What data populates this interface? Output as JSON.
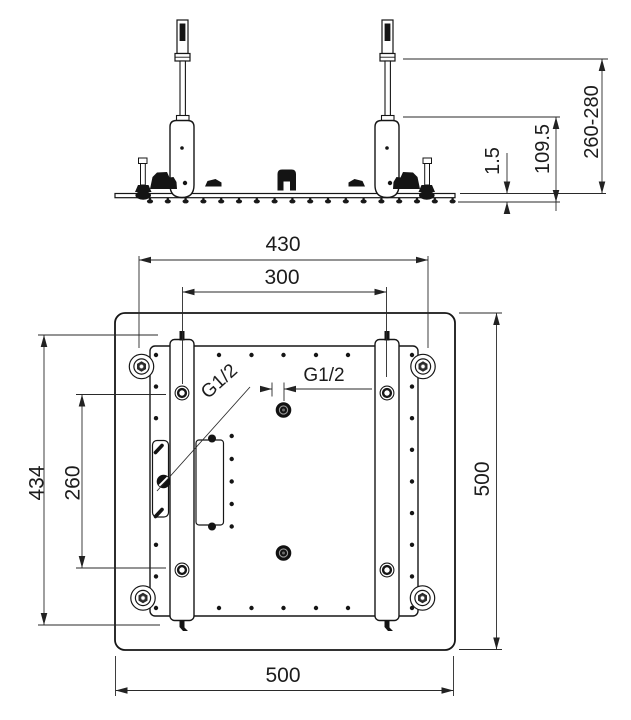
{
  "drawing": {
    "side_view": {
      "dim_plate_thickness": "1.5",
      "dim_body_drop": "109.5",
      "dim_install_range": "260-280"
    },
    "plan_view": {
      "dim_width_top": "430",
      "dim_pipe_spacing": "300",
      "dim_rail_length": "434",
      "dim_hole_spacing": "260",
      "dim_side_right": "500",
      "dim_side_bottom": "500",
      "thread_side": "G1/2",
      "thread_center": "G1/2"
    }
  }
}
